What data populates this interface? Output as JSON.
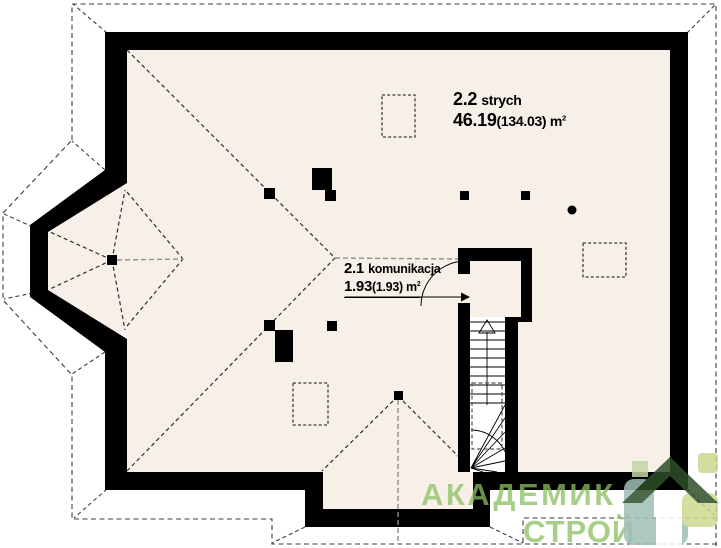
{
  "rooms": [
    {
      "id": "2.2",
      "name": "strych",
      "area": "46.19",
      "area_secondary": "(134.03)",
      "unit_base": " m",
      "unit_exp": "2"
    },
    {
      "id": "2.1",
      "name": "komunikacja",
      "area": "1.93",
      "area_secondary": "(1.93)",
      "unit_base": " m",
      "unit_exp": "2"
    }
  ],
  "watermark": {
    "word1": "АКАДЕМИК",
    "word2": "СТРОЙ"
  },
  "colors": {
    "wall": "#000000",
    "floor_fill": "#f6f0e9",
    "dash_dark": "#3c3c3c",
    "ridge_gray": "#8f8f8f",
    "logo_text_green": "#9dcb7d",
    "logo_roof_green": "#2e4f2a",
    "logo_teal": "#9fbfb7",
    "logo_lime": "#cdd98f"
  }
}
